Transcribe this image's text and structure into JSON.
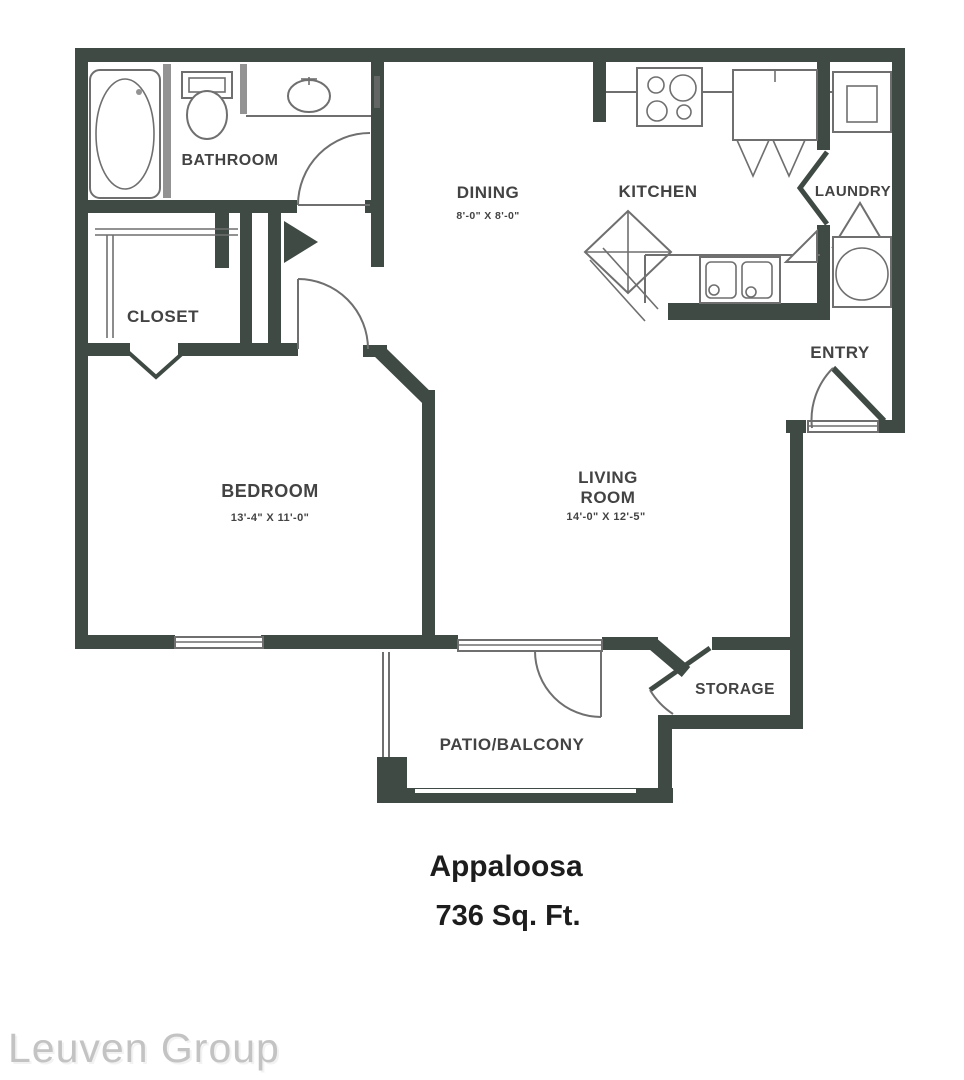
{
  "colors": {
    "wall": "#3e4a43",
    "line": "#6f6f6f",
    "label": "#434343",
    "title": "#1d1d1d",
    "wmback": "#c3c3c3",
    "wmfront": "#f2f2f2"
  },
  "plan": {
    "name": "Appaloosa",
    "area": "736 Sq. Ft."
  },
  "rooms": {
    "bathroom": {
      "label": "BATHROOM"
    },
    "closet": {
      "label": "CLOSET"
    },
    "dining": {
      "label": "DINING",
      "dims": "8'-0\" X 8'-0\""
    },
    "kitchen": {
      "label": "KITCHEN"
    },
    "laundry": {
      "label": "LAUNDRY"
    },
    "entry": {
      "label": "ENTRY"
    },
    "bedroom": {
      "label": "BEDROOM",
      "dims": "13'-4\" X 11'-0\""
    },
    "living": {
      "label_line1": "LIVING",
      "label_line2": "ROOM",
      "dims": "14'-0\" X 12'-5\""
    },
    "storage": {
      "label": "STORAGE"
    },
    "patio": {
      "label": "PATIO/BALCONY"
    }
  },
  "watermark": {
    "text": "Leuven Group"
  },
  "fixtures": [
    "bathtub",
    "toilet",
    "bathroom-sink",
    "closet-shelves",
    "stove",
    "refrigerator",
    "kitchen-island",
    "kitchen-sink",
    "corner-shelf",
    "dryer",
    "washer",
    "bedroom-window",
    "entry-door",
    "patio-door",
    "storage-door",
    "bathroom-door",
    "bedroom-door",
    "closet-bifold-door",
    "laundry-bifold-door",
    "linen-closet-doors"
  ]
}
